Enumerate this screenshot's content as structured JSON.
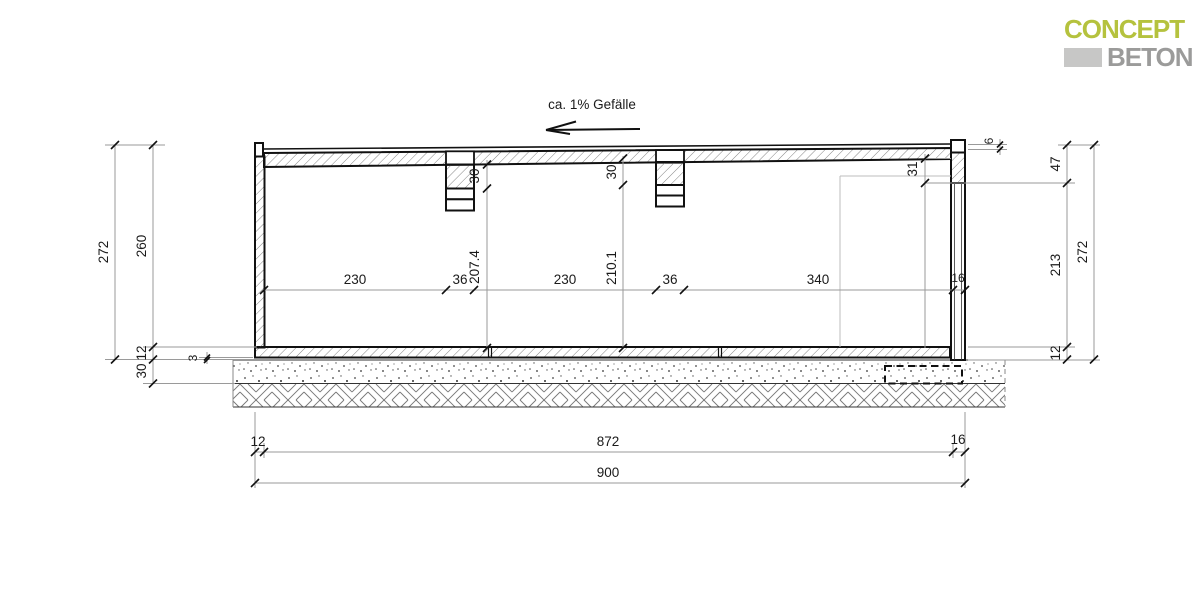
{
  "logo": {
    "line1": "CONCEPT",
    "line2": "BETON",
    "concept_color": "#b5c23e",
    "beton_color": "#9b9b9a",
    "block_color": "#c7c7c6"
  },
  "annotation": {
    "slope_label": "ca. 1% Gefälle"
  },
  "dimensions": {
    "left": {
      "overall_height": "272",
      "inner_height": "260",
      "floor_slab": "12",
      "base_layer": "30",
      "thin_layer": "3"
    },
    "right": {
      "parapet_upstand": "6",
      "edge_zone": "47",
      "clear_height": "213",
      "floor_slab": "12",
      "overall_height": "272",
      "edge_beam_depth": "31"
    },
    "interior": {
      "bay1": "230",
      "beam1_width": "36",
      "clear1": "207.4",
      "bay2": "230",
      "clear2": "210.1",
      "beam2_width": "36",
      "bay3": "340",
      "wall_thickness": "16",
      "beam1_depth": "30",
      "beam2_depth": "30"
    },
    "bottom": {
      "wall_left": "12",
      "inner_width": "872",
      "wall_right": "16",
      "overall_width": "900"
    }
  }
}
